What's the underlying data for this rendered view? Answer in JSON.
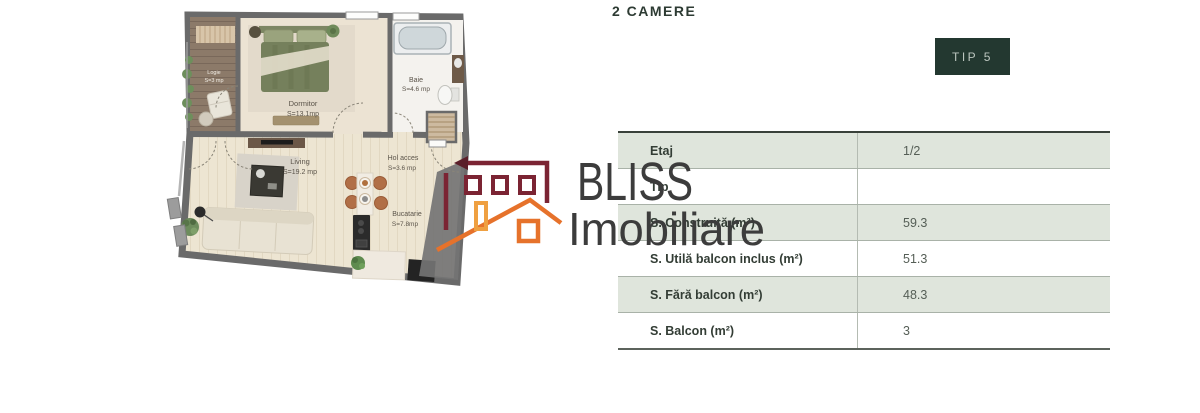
{
  "header": {
    "title": "2 CAMERE",
    "badge": "TIP 5"
  },
  "watermark": {
    "brand_line1": "BLISS",
    "brand_line2": "Imobiliare",
    "icon": "house-logo-icon"
  },
  "colors": {
    "accent_dark_green": "#233830",
    "table_row_green": "#dfe5dc",
    "logo_maroon": "#7b2433",
    "logo_orange": "#e6722b",
    "wall_gray": "#6a6a6a"
  },
  "floorplan": {
    "rooms": [
      {
        "name": "Logie",
        "area": "S=3 mp"
      },
      {
        "name": "Dormitor",
        "area": "S=13.1mp"
      },
      {
        "name": "Baie",
        "area": "S=4.6 mp"
      },
      {
        "name": "Living",
        "area": "S=19.2 mp"
      },
      {
        "name": "Hol acces",
        "area": "S=3.6 mp"
      },
      {
        "name": "Bucatarie",
        "area": "S=7.8mp"
      }
    ]
  },
  "table": {
    "rows": [
      {
        "label": "Etaj",
        "value": "1/2"
      },
      {
        "label": "Tip",
        "value": ""
      },
      {
        "label": "S. Construită (m²)",
        "value": "59.3"
      },
      {
        "label": "S. Utilă balcon inclus (m²)",
        "value": "51.3"
      },
      {
        "label": "S. Fără balcon (m²)",
        "value": "48.3"
      },
      {
        "label": "S. Balcon (m²)",
        "value": "3"
      }
    ]
  }
}
